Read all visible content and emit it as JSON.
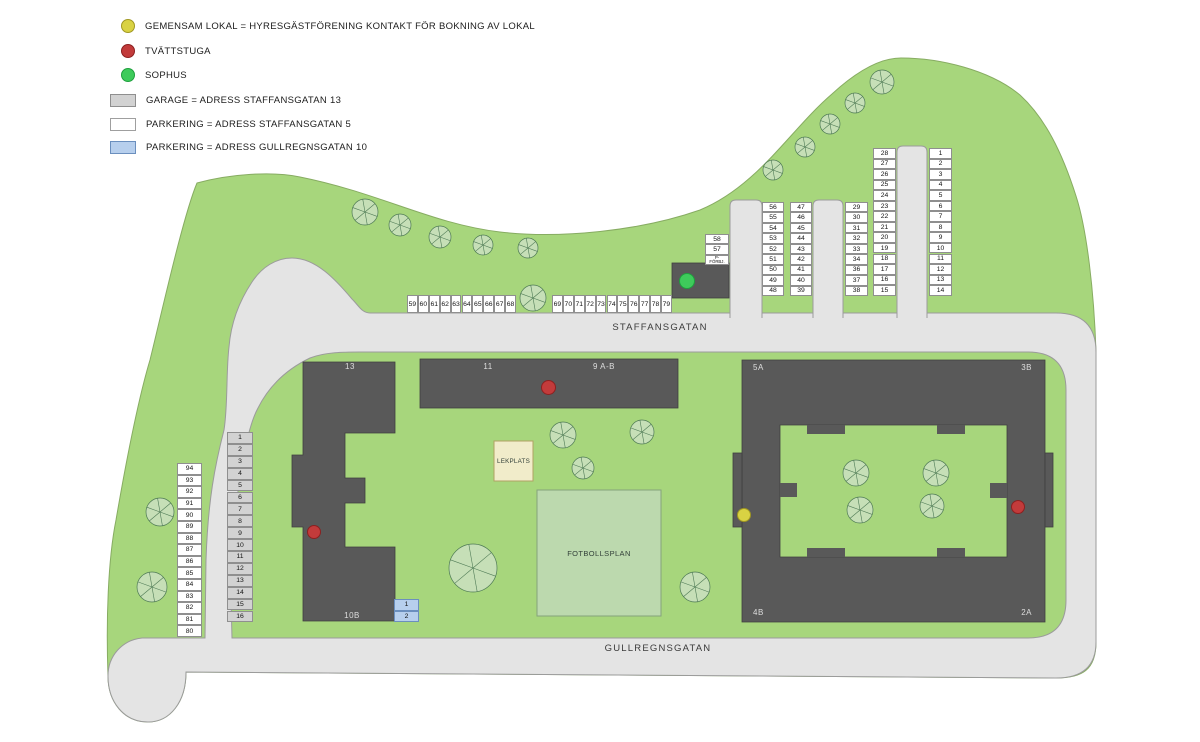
{
  "colors": {
    "green": "#a7d67c",
    "greenEdge": "#87ac62",
    "road": "#e4e4e4",
    "roadStroke": "#9b9b9b",
    "building": "#595959",
    "buildingStroke": "#3f3f3f",
    "buildingLabel": "#dedede",
    "cellWhite": "#ffffff",
    "cellBorder": "#8f8f8f",
    "cellGarage": "#d2d2d2",
    "cellBlue": "#b7cfed",
    "cellBlueBorder": "#6b8fbe",
    "lekplats": "#f1ecca",
    "lekplatsBorder": "#b0a263",
    "fotboll": "#bcd9ae",
    "fotbollBorder": "#85a37b",
    "tree": "#c6dfb7",
    "treeStroke": "#4e7a55",
    "yellow": "#d9d243",
    "yellowStroke": "#a19822",
    "red": "#c23b3b",
    "redStroke": "#8c2020",
    "greenDot": "#3ecb5b",
    "greenDotStroke": "#1fa03e",
    "text": "#1c1c1c",
    "streetText": "#3a3a3a"
  },
  "legend": {
    "items": [
      {
        "id": "gemensam-lokal",
        "label": "GEMENSAM LOKAL = HYRESGÄSTFÖRENING KONTAKT FÖR BOKNING AV LOKAL"
      },
      {
        "id": "tvattstuga",
        "label": "TVÄTTSTUGA"
      },
      {
        "id": "sophus",
        "label": "SOPHUS"
      },
      {
        "id": "garage",
        "label": "GARAGE = ADRESS STAFFANSGATAN 13"
      },
      {
        "id": "parkering-staffansgatan",
        "label": "PARKERING = ADRESS STAFFANSGATAN 5"
      },
      {
        "id": "parkering-gullregnsgatan",
        "label": "PARKERING = ADRESS GULLREGNSGATAN 10"
      }
    ]
  },
  "streets": {
    "staffansgatan": "STAFFANSGATAN",
    "gullregnsgatan": "GULLREGNSGATAN"
  },
  "areas": {
    "lekplats": "LEKPLATS",
    "fotbollsplan": "FOTBOLLSPLAN"
  },
  "buildings": {
    "b13": "13",
    "b11": "11",
    "b9": "9 A-B",
    "b5a": "5A",
    "b3b": "3B",
    "b4b": "4B",
    "b2a": "2A",
    "b10b": "10B"
  },
  "parking": {
    "groups": [
      {
        "id": "row59",
        "kind": "parkering",
        "cells": [
          "59",
          "60",
          "61",
          "62",
          "63",
          "64",
          "65",
          "66",
          "67",
          "68"
        ]
      },
      {
        "id": "row69",
        "kind": "parkering",
        "cells": [
          "69",
          "70",
          "71",
          "72",
          "73",
          "74",
          "75",
          "76",
          "77",
          "78",
          "79"
        ]
      },
      {
        "id": "col58",
        "kind": "parkering",
        "cells": [
          "58",
          "57",
          "P-FÖRBJ."
        ]
      },
      {
        "id": "col56",
        "kind": "parkering",
        "cells": [
          "56",
          "55",
          "54",
          "53",
          "52",
          "51",
          "50",
          "49",
          "48"
        ]
      },
      {
        "id": "col47",
        "kind": "parkering",
        "cells": [
          "47",
          "46",
          "45",
          "44",
          "43",
          "42",
          "41",
          "40",
          "39"
        ]
      },
      {
        "id": "col29",
        "kind": "parkering",
        "cells": [
          "29",
          "30",
          "31",
          "32",
          "33",
          "34",
          "36",
          "37",
          "38"
        ]
      },
      {
        "id": "col28",
        "kind": "parkering",
        "cells": [
          "28",
          "27",
          "26",
          "25",
          "24",
          "23",
          "22",
          "21",
          "20",
          "19",
          "18",
          "17",
          "16",
          "15"
        ]
      },
      {
        "id": "col1r",
        "kind": "parkering",
        "cells": [
          "1",
          "2",
          "3",
          "4",
          "5",
          "6",
          "7",
          "8",
          "9",
          "10",
          "11",
          "12",
          "13",
          "14"
        ]
      },
      {
        "id": "col94",
        "kind": "parkering",
        "cells": [
          "94",
          "93",
          "92",
          "91",
          "90",
          "89",
          "88",
          "87",
          "86",
          "85",
          "84",
          "83",
          "82",
          "81",
          "80"
        ]
      },
      {
        "id": "colgarage",
        "kind": "garage",
        "cells": [
          "1",
          "2",
          "3",
          "4",
          "5",
          "6",
          "7",
          "8",
          "9",
          "10",
          "11",
          "12",
          "13",
          "14",
          "15",
          "16"
        ]
      },
      {
        "id": "blue12",
        "kind": "blue",
        "cells": [
          "1",
          "2"
        ]
      }
    ]
  },
  "markers": [
    {
      "id": "marker-sophus",
      "type": "sophus"
    },
    {
      "id": "marker-tvattstuga-13",
      "type": "tvattstuga"
    },
    {
      "id": "marker-tvattstuga-9",
      "type": "tvattstuga"
    },
    {
      "id": "marker-tvattstuga-2a",
      "type": "tvattstuga"
    },
    {
      "id": "marker-gemensam-lokal",
      "type": "gemensam_lokal"
    }
  ]
}
